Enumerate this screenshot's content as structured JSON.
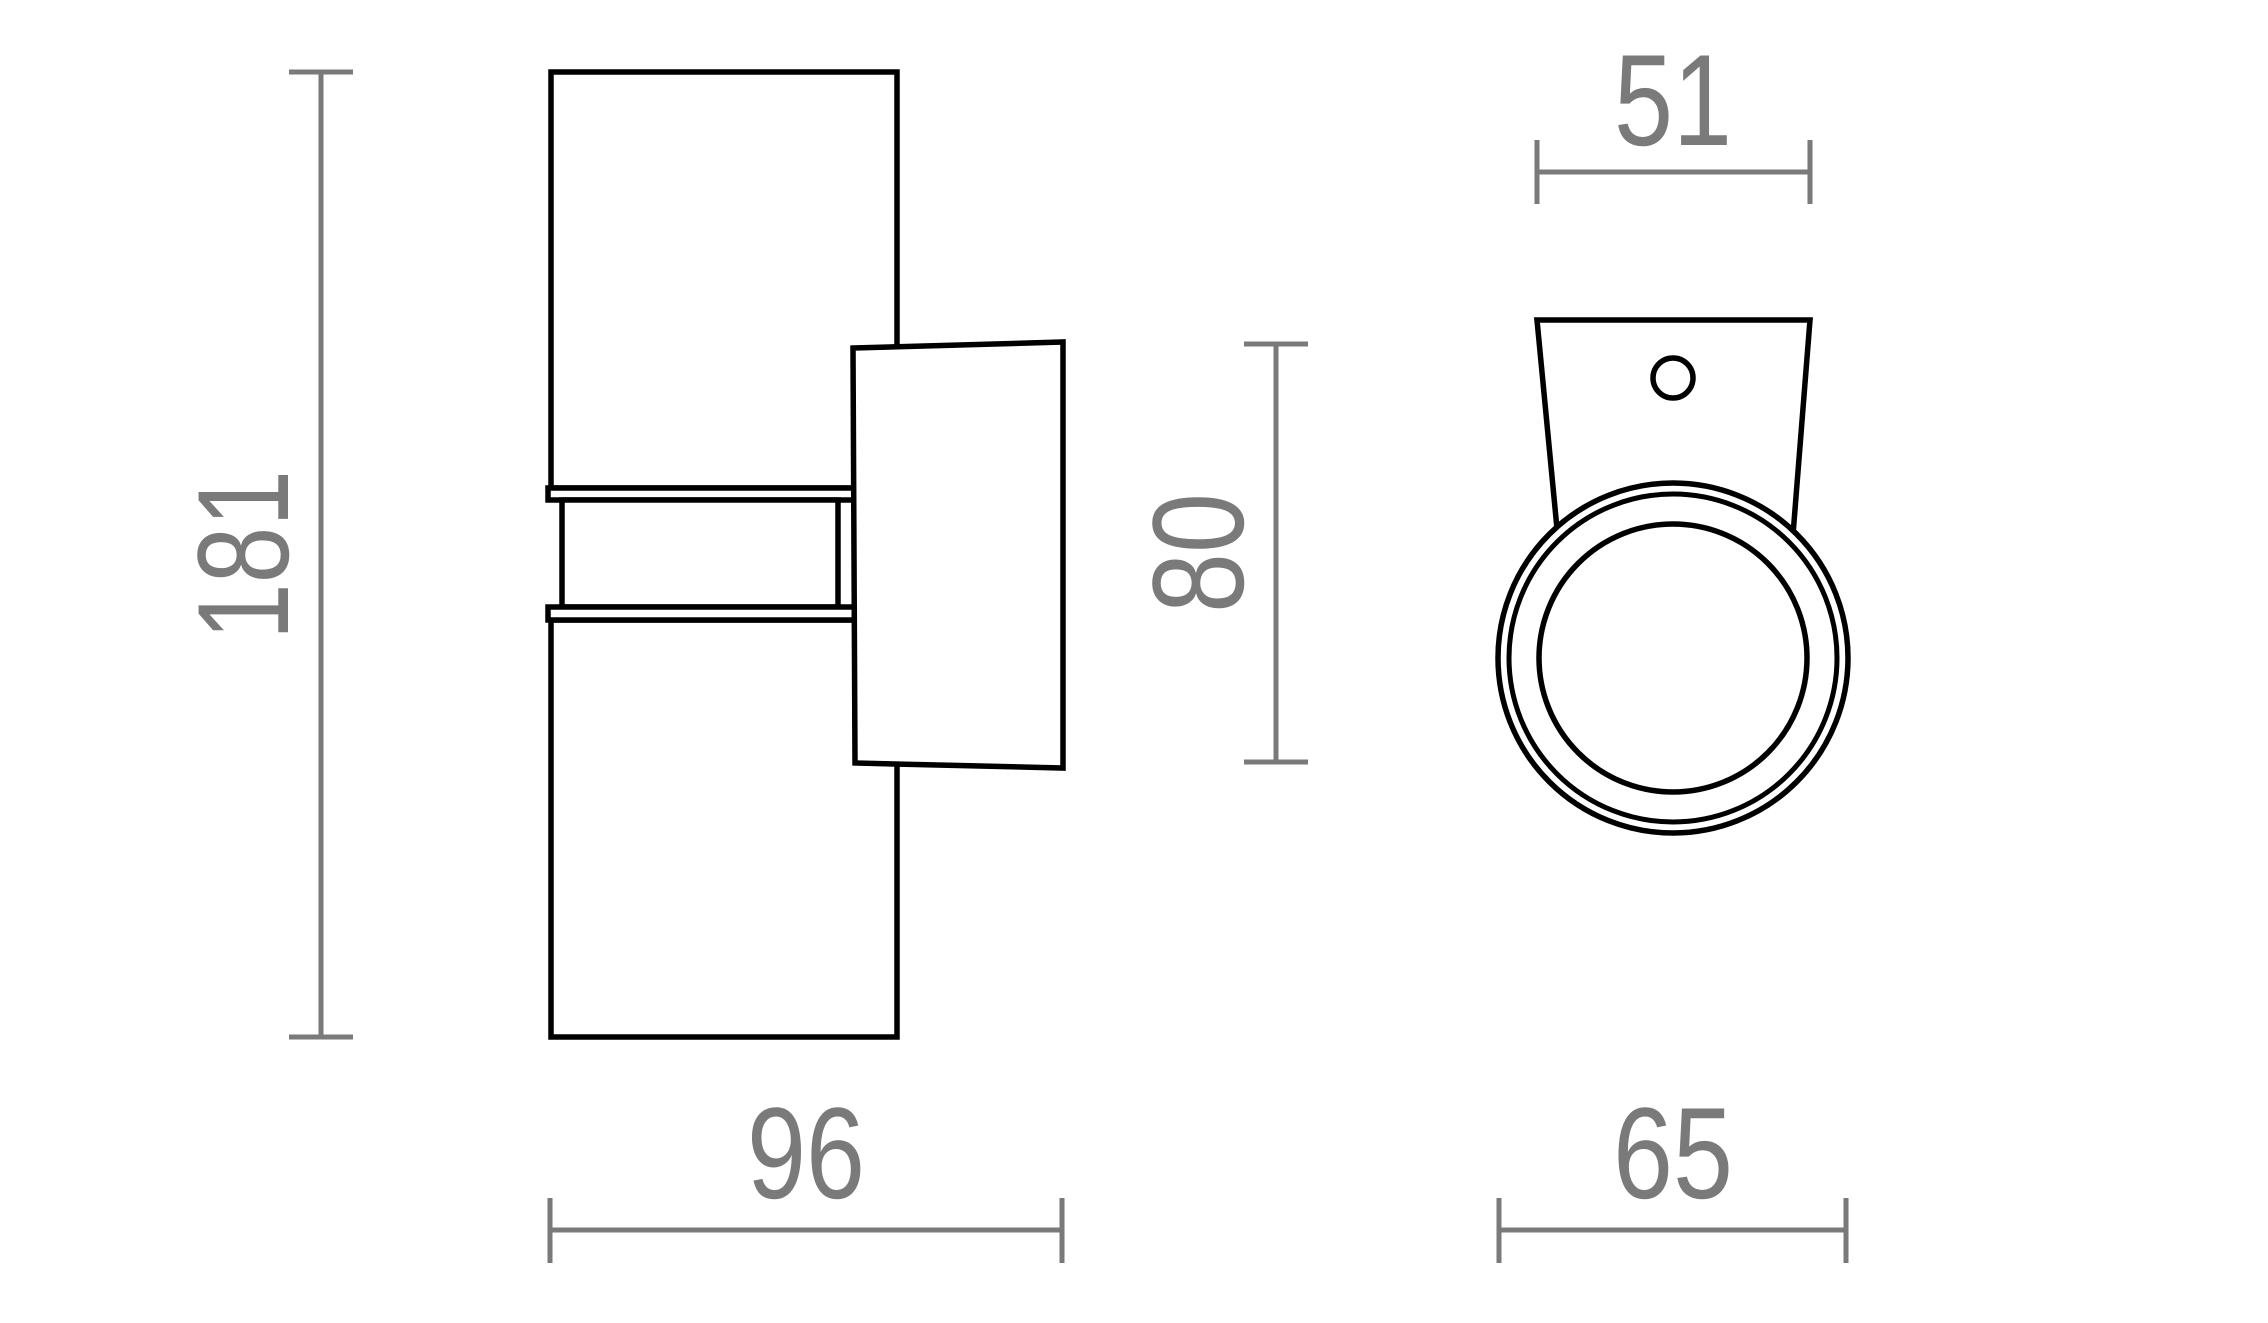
{
  "page": {
    "background": "#ffffff",
    "description": "technical dimension drawing of a cylindrical up-down wall light, side view and front view"
  },
  "drawing": {
    "outline_color": "#000000",
    "dimension_color": "#7a7a7a",
    "views": [
      {
        "name": "side view"
      },
      {
        "name": "front view"
      }
    ]
  },
  "dimensions": {
    "height": "181",
    "depth": "96",
    "plate_height": "80",
    "plate_top_width": "51",
    "diameter": "65"
  }
}
